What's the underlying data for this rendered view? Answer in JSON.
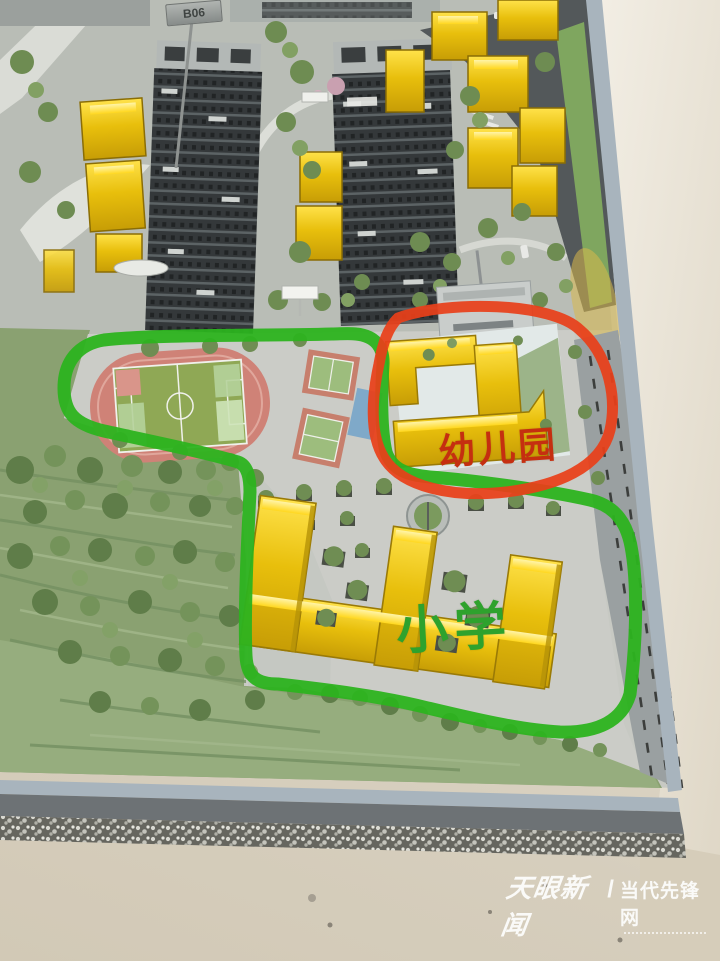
{
  "photo": {
    "description_label": "architectural-scale-model-photo"
  },
  "annotations": {
    "kindergarten_label": "幼儿园",
    "primary_school_label": "小学",
    "red_circle_color": "#e8401a",
    "green_circle_color": "#2cb31f"
  },
  "signs": {
    "plot_sign": "B06"
  },
  "watermark": {
    "brand": "天眼新闻",
    "separator": "/",
    "site": "当代先锋网",
    "color": "#ffffff"
  },
  "model_colors": {
    "acrylic_building_yellow": "#e8c212",
    "track_pink": "#cf8277",
    "field_green": "#8fa855",
    "hillside_green": "#8aa171",
    "tower_dark": "#3c4041",
    "base_trim_blue_gray": "#a8b4bd"
  }
}
